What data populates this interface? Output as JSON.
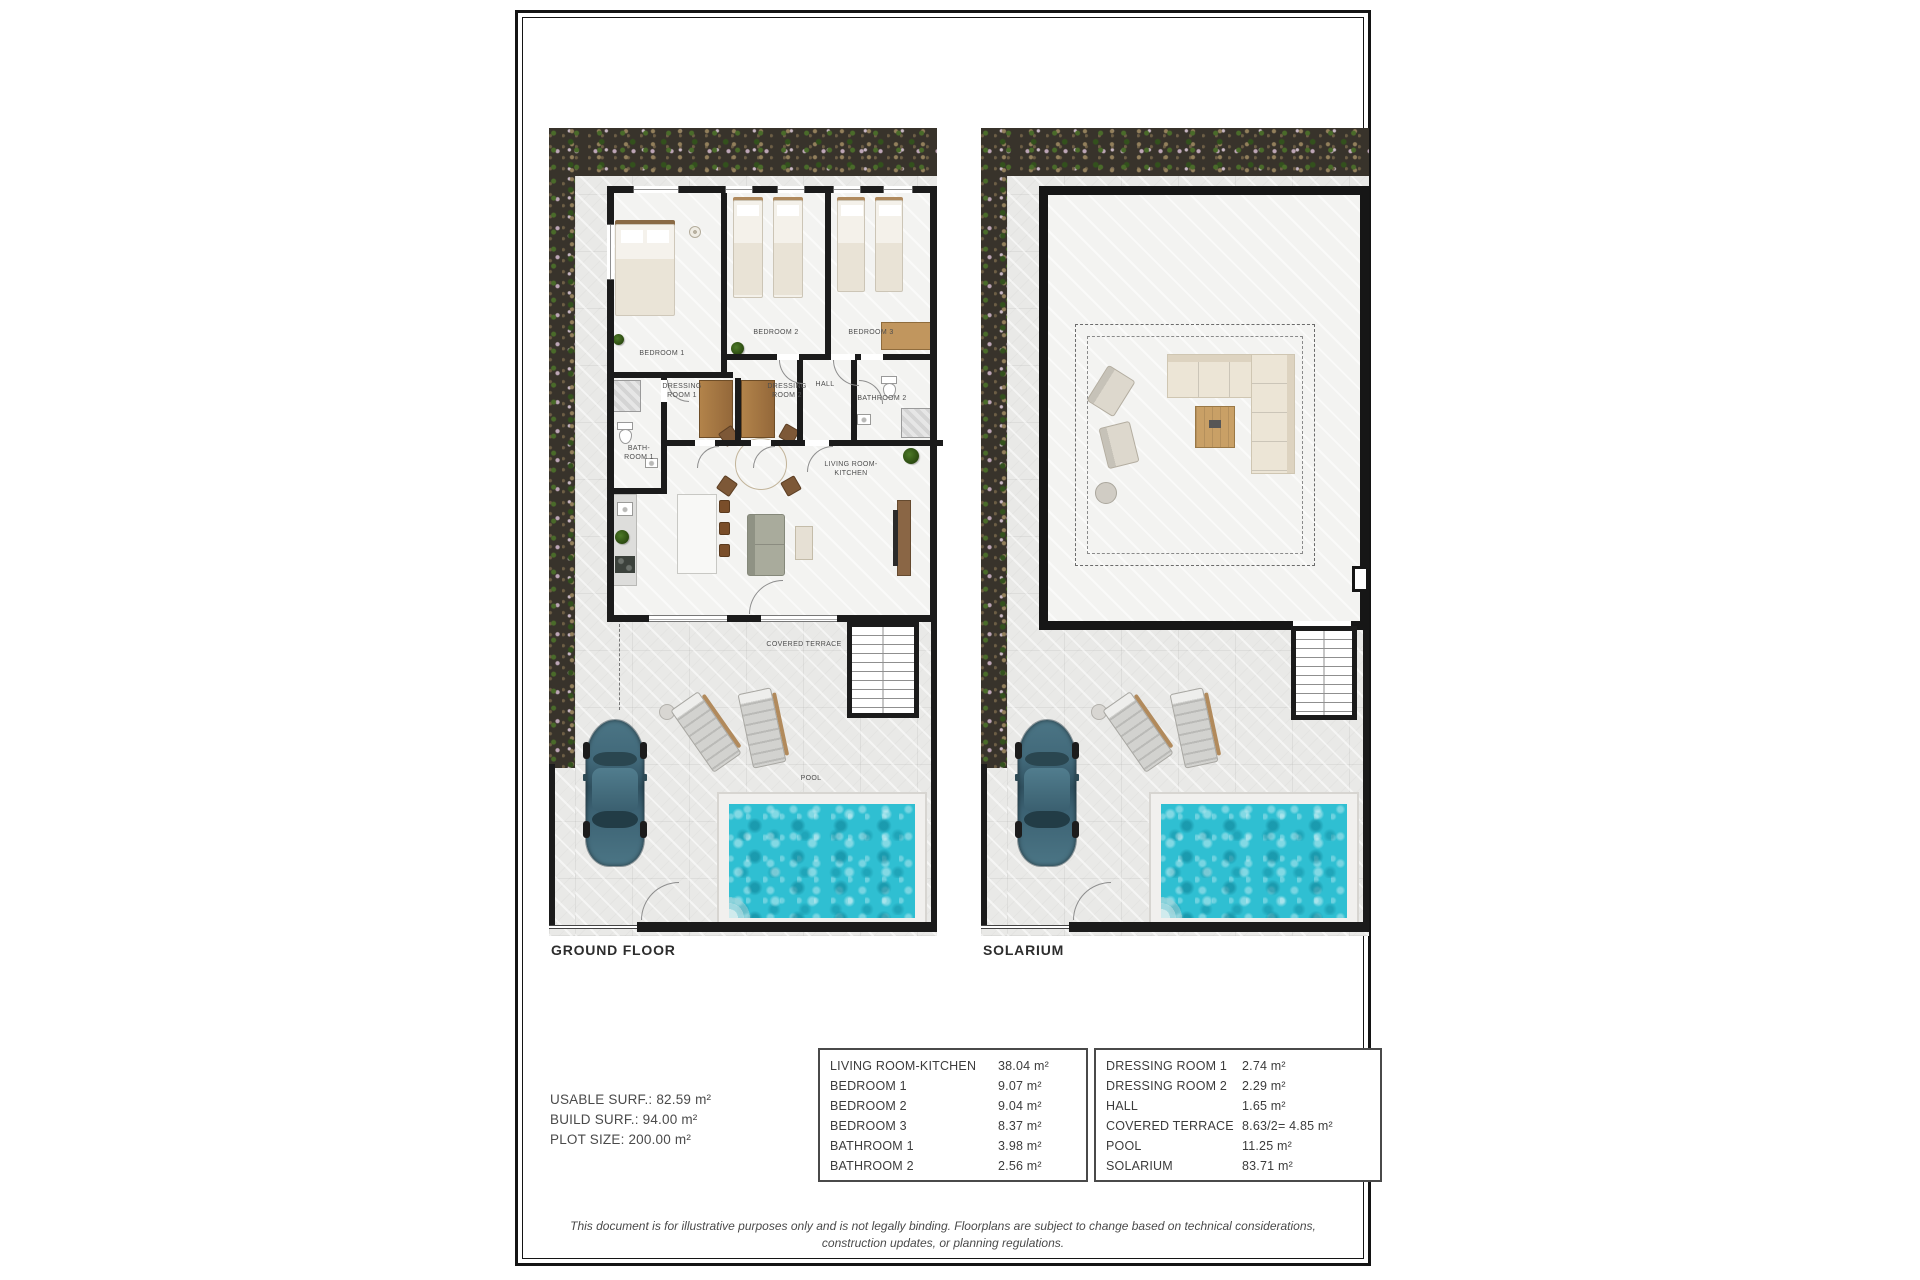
{
  "plans": {
    "ground": {
      "label": "GROUND FLOOR",
      "rooms": {
        "bedroom1": "BEDROOM 1",
        "bedroom2": "BEDROOM 2",
        "bedroom3": "BEDROOM 3",
        "dressing1": "DRESSING\nROOM 1",
        "dressing2": "DRESSING\nROOM 2",
        "hall": "HALL",
        "bathroom2": "BATHROOM 2",
        "bathroom1": "BATH-\nROOM 1",
        "living": "LIVING ROOM-KITCHEN",
        "covered_terrace": "COVERED TERRACE",
        "pool": "POOL"
      }
    },
    "solarium": {
      "label": "SOLARIUM"
    }
  },
  "summary": {
    "usable": "USABLE SURF.: 82.59 m²",
    "build": "BUILD SURF.: 94.00 m²",
    "plot": "PLOT SIZE: 200.00 m²"
  },
  "area_tables": [
    {
      "rows": [
        [
          "LIVING ROOM-KITCHEN",
          "38.04 m²"
        ],
        [
          "BEDROOM 1",
          "9.07 m²"
        ],
        [
          "BEDROOM 2",
          "9.04 m²"
        ],
        [
          "BEDROOM 3",
          "8.37 m²"
        ],
        [
          "BATHROOM 1",
          "3.98 m²"
        ],
        [
          "BATHROOM 2",
          "2.56 m²"
        ]
      ]
    },
    {
      "rows": [
        [
          "DRESSING ROOM 1",
          "2.74 m²"
        ],
        [
          "DRESSING ROOM 2",
          "2.29 m²"
        ],
        [
          "HALL",
          "1.65 m²"
        ],
        [
          "COVERED TERRACE",
          "8.63/2= 4.85 m²"
        ],
        [
          "POOL",
          "11.25 m²"
        ],
        [
          "SOLARIUM",
          "83.71 m²"
        ]
      ]
    }
  ],
  "disclaimer": {
    "line1": "This document is for illustrative purposes only and is not legally binding. Floorplans are subject to change based on technical considerations,",
    "line2": "construction updates, or planning regulations."
  },
  "colors": {
    "pool_water": "#2fbfd2",
    "wall": "#1b1b1b",
    "garden": "#38332b",
    "paving": "#e9e9e7"
  }
}
